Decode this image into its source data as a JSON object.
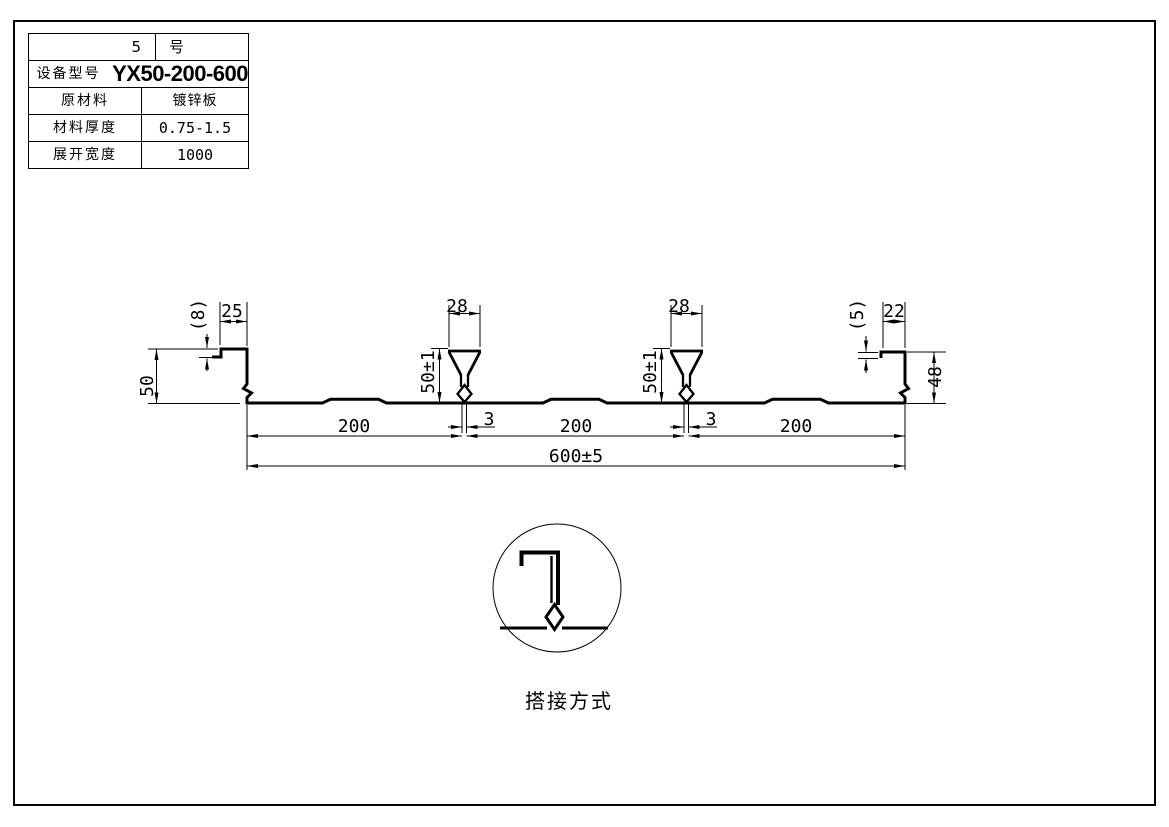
{
  "page": {
    "background": "#ffffff",
    "line_color": "#000000"
  },
  "title_block": {
    "model_no_left": "5",
    "model_no_right": "号",
    "rows": [
      {
        "label": "设备型号",
        "value": "YX50-200-600"
      },
      {
        "label": "原材料",
        "value": "镀锌板"
      },
      {
        "label": "材料厚度",
        "value": "0.75-1.5"
      },
      {
        "label": "展开宽度",
        "value": "1000"
      }
    ]
  },
  "dims": {
    "left_lip": "(8)",
    "left_top_flange": "25",
    "left_edge_height": "50",
    "rib_top_width": "28",
    "rib_height": "50±1",
    "rib_stem_width": "3",
    "right_lip": "(5)",
    "right_top_flange": "22",
    "right_edge_height": "48",
    "pitch": "200",
    "overall_width": "600±5"
  },
  "detail": {
    "caption": "搭接方式"
  }
}
